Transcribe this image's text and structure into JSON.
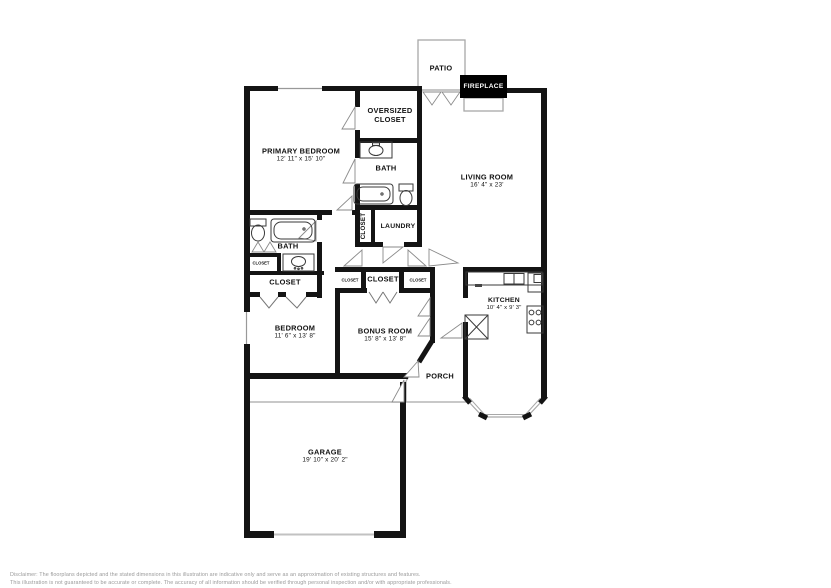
{
  "rooms": {
    "patio": {
      "label": "PATIO"
    },
    "fireplace": {
      "label": "FIREPLACE"
    },
    "oversized_closet": {
      "label": "OVERSIZED CLOSET"
    },
    "primary_bedroom": {
      "label": "PRIMARY BEDROOM",
      "dims": "12' 11\" x 15' 10\""
    },
    "primary_bath": {
      "label": "BATH"
    },
    "living_room": {
      "label": "LIVING ROOM",
      "dims": "16' 4\" x 23'"
    },
    "hall_closet_vertical": {
      "label": "CLOSET"
    },
    "laundry": {
      "label": "LAUNDRY"
    },
    "bath2": {
      "label": "BATH"
    },
    "hall_closet_small": {
      "label": "CLOSET"
    },
    "bedroom_closet": {
      "label": "CLOSET"
    },
    "bonus_closet_left": {
      "label": "CLOSET"
    },
    "bonus_closet_center": {
      "label": "CLOSET"
    },
    "bonus_closet_right": {
      "label": "CLOSET"
    },
    "bedroom": {
      "label": "BEDROOM",
      "dims": "11' 6\" x 13' 8\""
    },
    "bonus_room": {
      "label": "BONUS ROOM",
      "dims": "15' 8\" x 13' 8\""
    },
    "kitchen": {
      "label": "KITCHEN",
      "dims": "10' 4\" x 9' 3\""
    },
    "porch": {
      "label": "PORCH"
    },
    "garage": {
      "label": "GARAGE",
      "dims": "19' 10\" x 20' 2\""
    }
  },
  "colors": {
    "wall": "#141414",
    "thin_line": "#a8a8a8",
    "fixture": "#3a3a3a",
    "fireplace_bg": "#000000",
    "fireplace_text": "#ffffff",
    "disclaimer_text": "#9a9a9a"
  },
  "disclaimer": {
    "line1": "Disclaimer: The floorplans depicted and the stated dimensions in this illustration are indicative only and serve as an approximation of existing structures and features.",
    "line2": "This illustration is not guaranteed to be accurate or complete. The accuracy of all information should be verified through personal inspection and/or with appropriate professionals."
  }
}
